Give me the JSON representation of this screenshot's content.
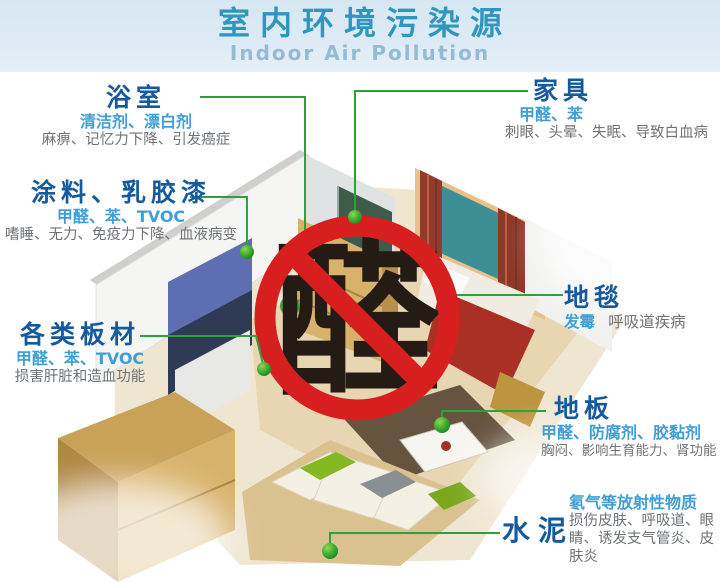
{
  "header": {
    "title": "室内环境污染源",
    "subtitle": "Indoor Air Pollution"
  },
  "center": {
    "ban_char": "醛",
    "ban_meaning": "prohibition-sign-over-aldehyde"
  },
  "callouts": {
    "bathroom": {
      "title": "浴室",
      "substances": "清洁剂、漂白剂",
      "effects": "麻痹、记忆力下降、引发癌症"
    },
    "paint": {
      "title": "涂料、乳胶漆",
      "substances": "甲醛、苯、TVOC",
      "effects": "嗜睡、无力、免疫力下降、血液病变"
    },
    "boards": {
      "title": "各类板材",
      "substances": "甲醛、苯、TVOC",
      "effects": "损害肝脏和造血功能"
    },
    "furniture": {
      "title": "家具",
      "substances": "甲醛、苯",
      "effects": "刺眼、头晕、失眠、导致白血病"
    },
    "carpet": {
      "title": "地毯",
      "substances": "发霉",
      "effects": "呼吸道疾病"
    },
    "floor": {
      "title": "地板",
      "substances": "甲醛、防腐剂、胶黏剂",
      "effects": "胸闷、影响生育能力、肾功能"
    },
    "cement": {
      "title": "水泥",
      "substances": "氡气等放射性物质",
      "effects": "损伤皮肤、呼吸道、眼睛、诱发支气管炎、皮肤炎"
    }
  },
  "colors": {
    "header_bg": "#dceaf5",
    "header_title": "#2f96bd",
    "header_subtitle": "#95bbd1",
    "callout_title": "#155a9e",
    "substance_text": "#3f9ed6",
    "effect_text": "#6f7276",
    "leader_line": "#2ba23b",
    "ban_red": "#d81f1f",
    "ban_char_color": "#241b14"
  }
}
